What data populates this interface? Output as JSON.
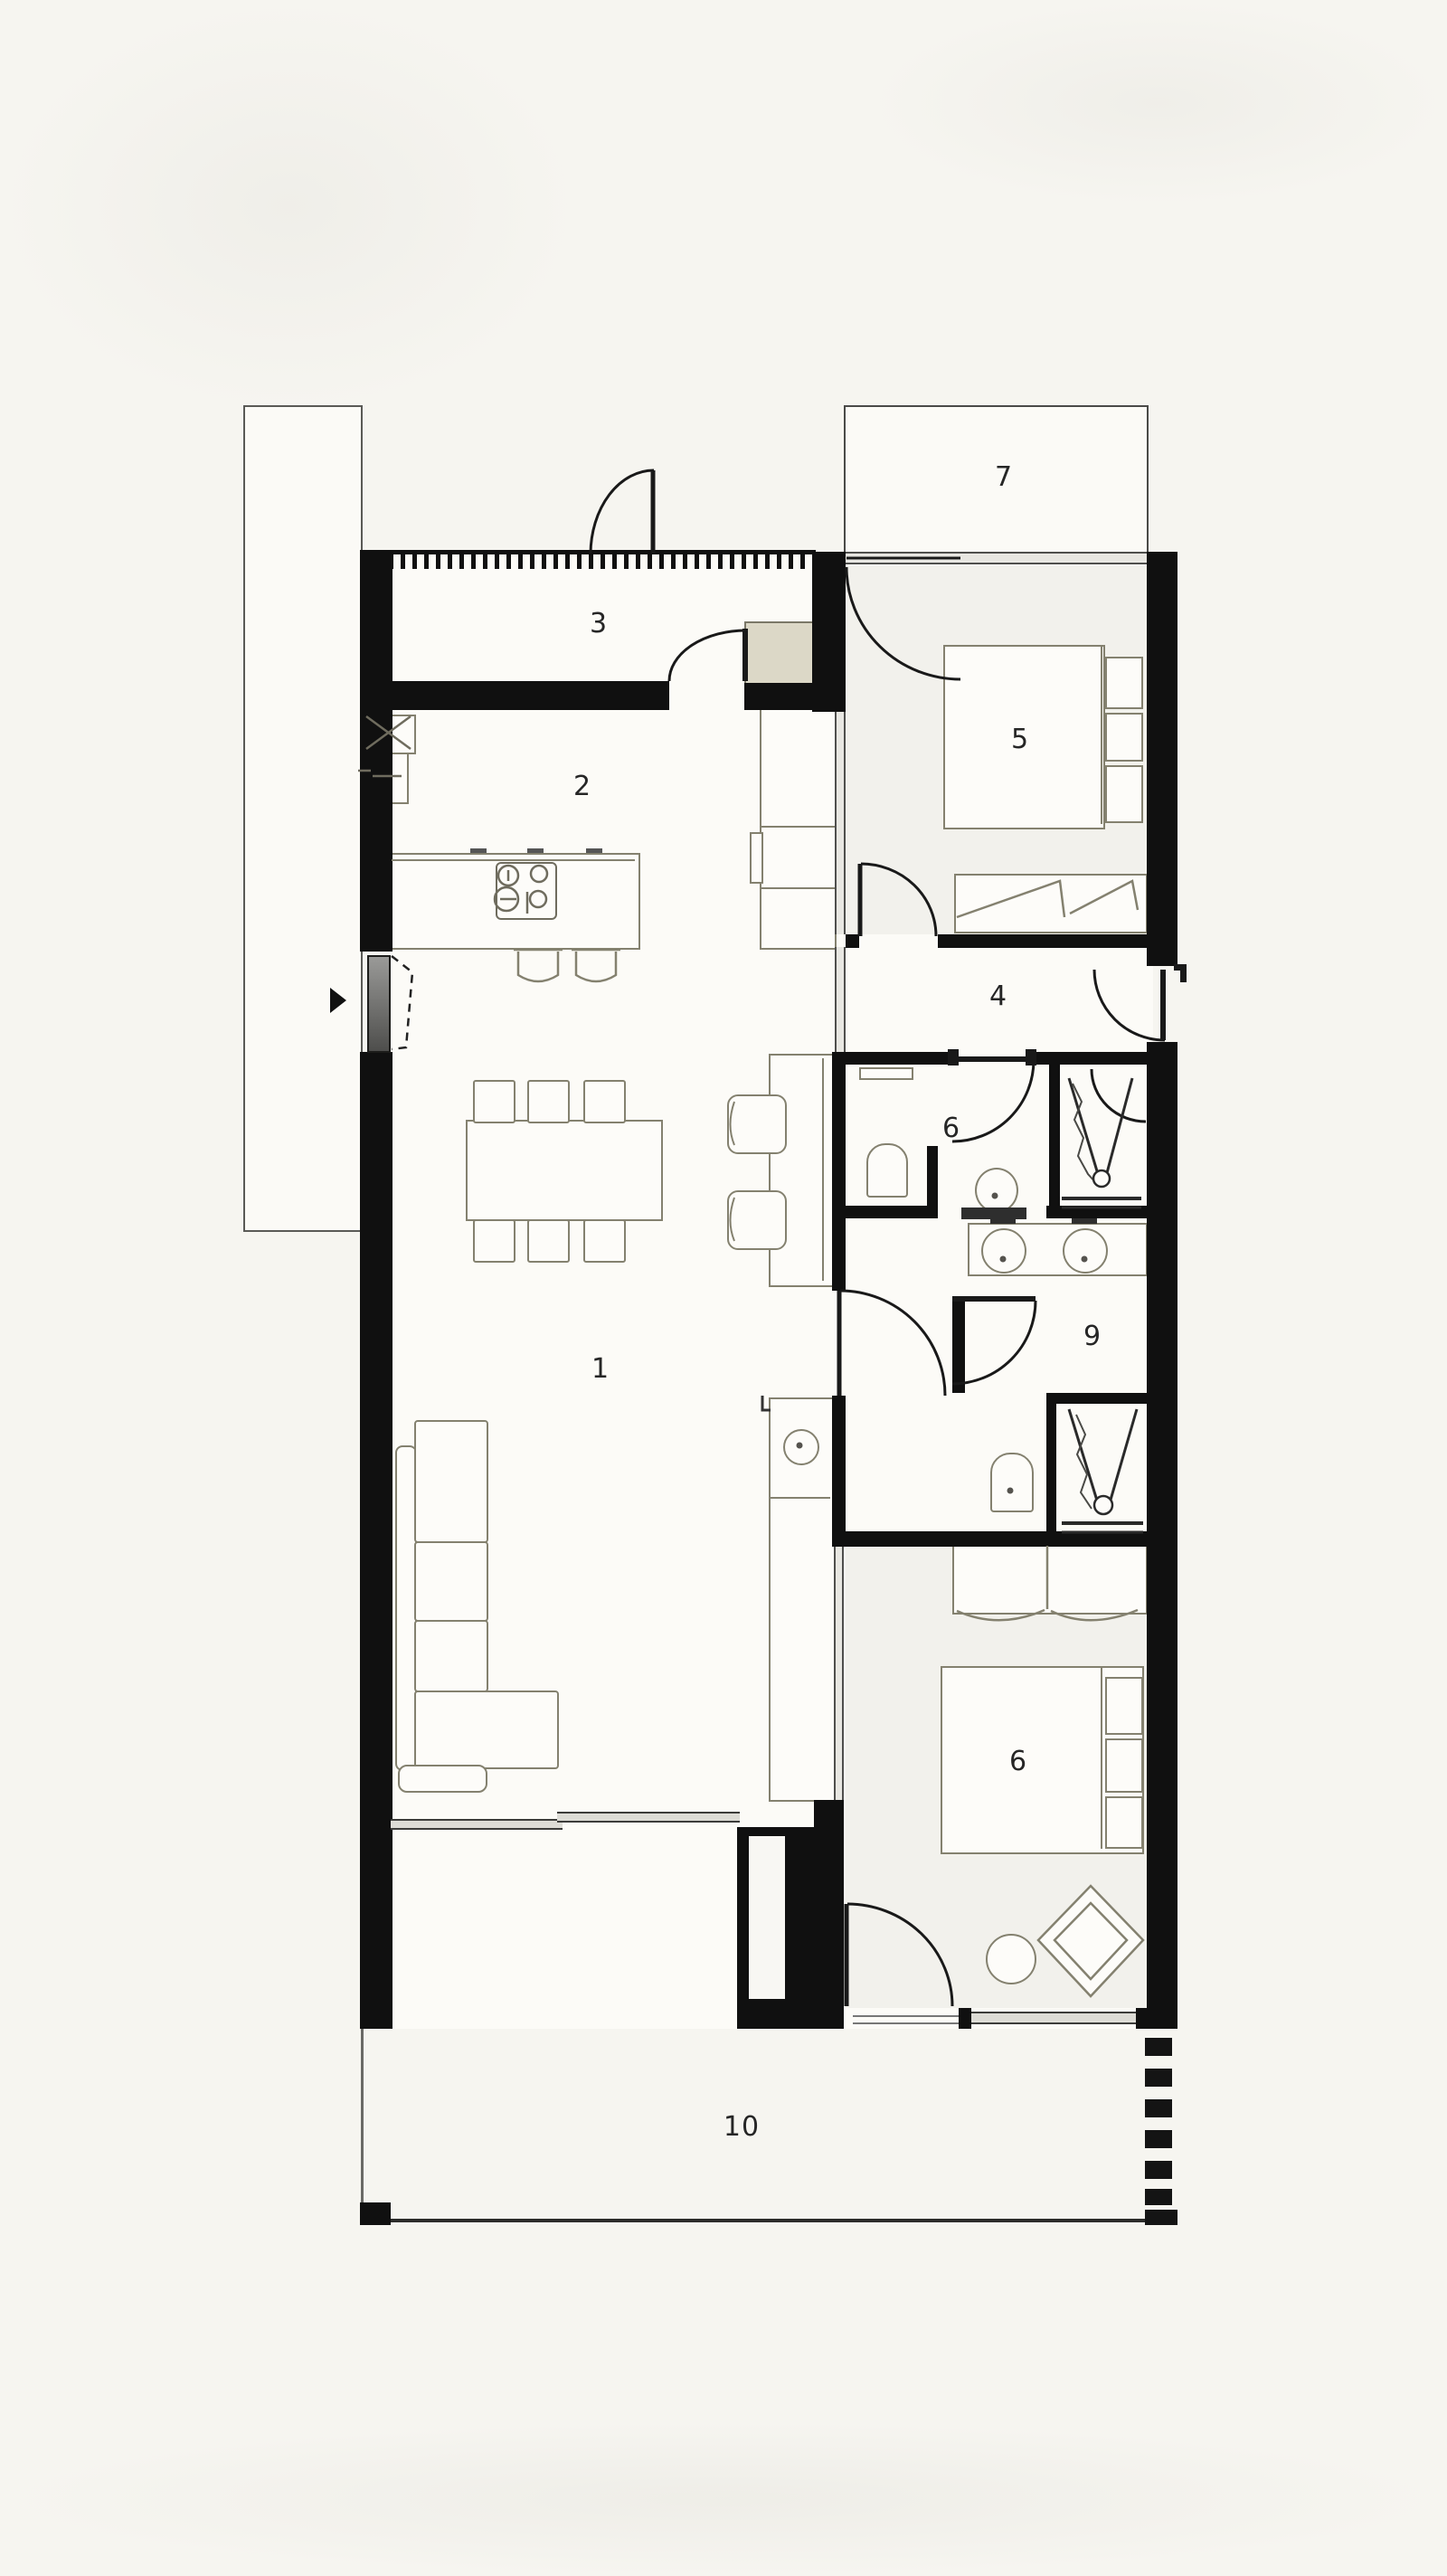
{
  "plan": {
    "type": "architectural-floor-plan",
    "rooms": {
      "living_dining": {
        "label": "1"
      },
      "kitchen": {
        "label": "2"
      },
      "entry_hall": {
        "label": "3"
      },
      "hallway": {
        "label": "4"
      },
      "bedroom_top": {
        "label": "5"
      },
      "bathroom": {
        "label": "6"
      },
      "terrace_top": {
        "label": "7"
      },
      "dressing_room": {
        "label": "9"
      },
      "bedroom_bottom": {
        "label": "6"
      },
      "terrace_bottom": {
        "label": "10"
      }
    },
    "colors": {
      "wall": "#101010",
      "furniture_line": "#84816f",
      "background": "#f6f5f0",
      "floor": "#fcfbf7",
      "cabinet_fill": "#dcd8c7",
      "door_leaf_gray": "#8a8a8a"
    }
  }
}
